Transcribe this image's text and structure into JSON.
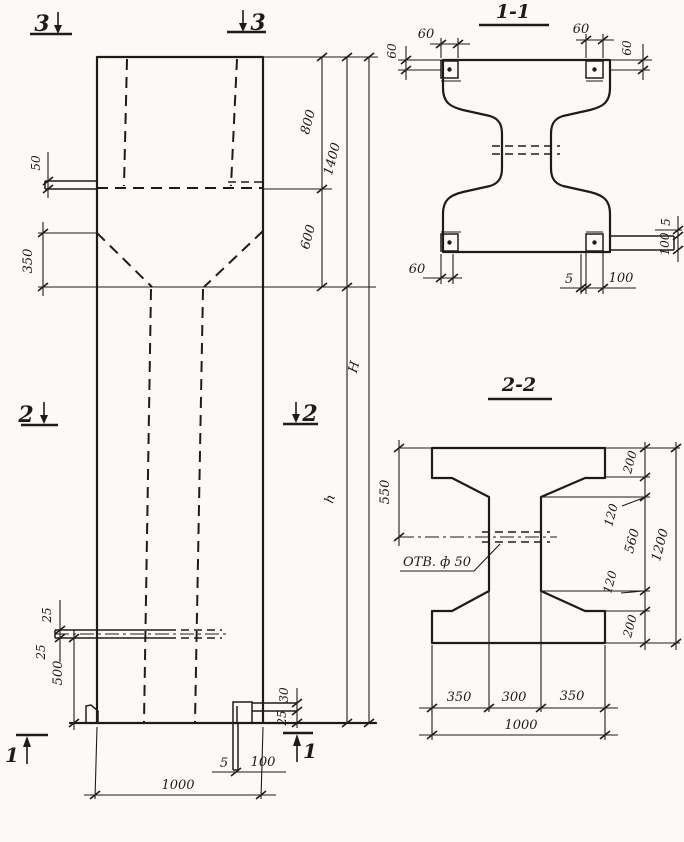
{
  "drawing": {
    "elevation": {
      "marker_3_left": "3",
      "marker_3_right": "3",
      "marker_2_left": "2",
      "marker_2_right": "2",
      "marker_1_left": "1",
      "marker_1_right": "1",
      "dim_ledge": "50",
      "dim_taper": "350",
      "dim_top": "800",
      "dim_head": "1400",
      "dim_neck": "600",
      "dim_total_height": "H",
      "dim_shaft_height": "h",
      "dim_slot_upper": "25",
      "dim_slot_lower": "25",
      "dim_foot": "500",
      "dim_corner_a": "30",
      "dim_corner_b": "25",
      "dim_plate_t": "5",
      "dim_plate_w": "100",
      "dim_width": "1000"
    },
    "section11": {
      "title": "1-1",
      "dim_tl_h": "60",
      "dim_tl_v": "60",
      "dim_tr_h": "60",
      "dim_tr_v": "60",
      "dim_bl": "60",
      "dim_br_t": "5",
      "dim_br_w": "100",
      "dim_r_t": "5",
      "dim_r_w": "100"
    },
    "section22": {
      "title": "2-2",
      "hole_label": "ОТВ. ф 50",
      "dim_550": "550",
      "dim_top_200": "200",
      "dim_taper_top_120": "120",
      "dim_web_560": "560",
      "dim_taper_bot_120": "120",
      "dim_bot_200": "200",
      "dim_1200": "1200",
      "dim_350a": "350",
      "dim_300": "300",
      "dim_350b": "350",
      "dim_1000": "1000"
    }
  }
}
